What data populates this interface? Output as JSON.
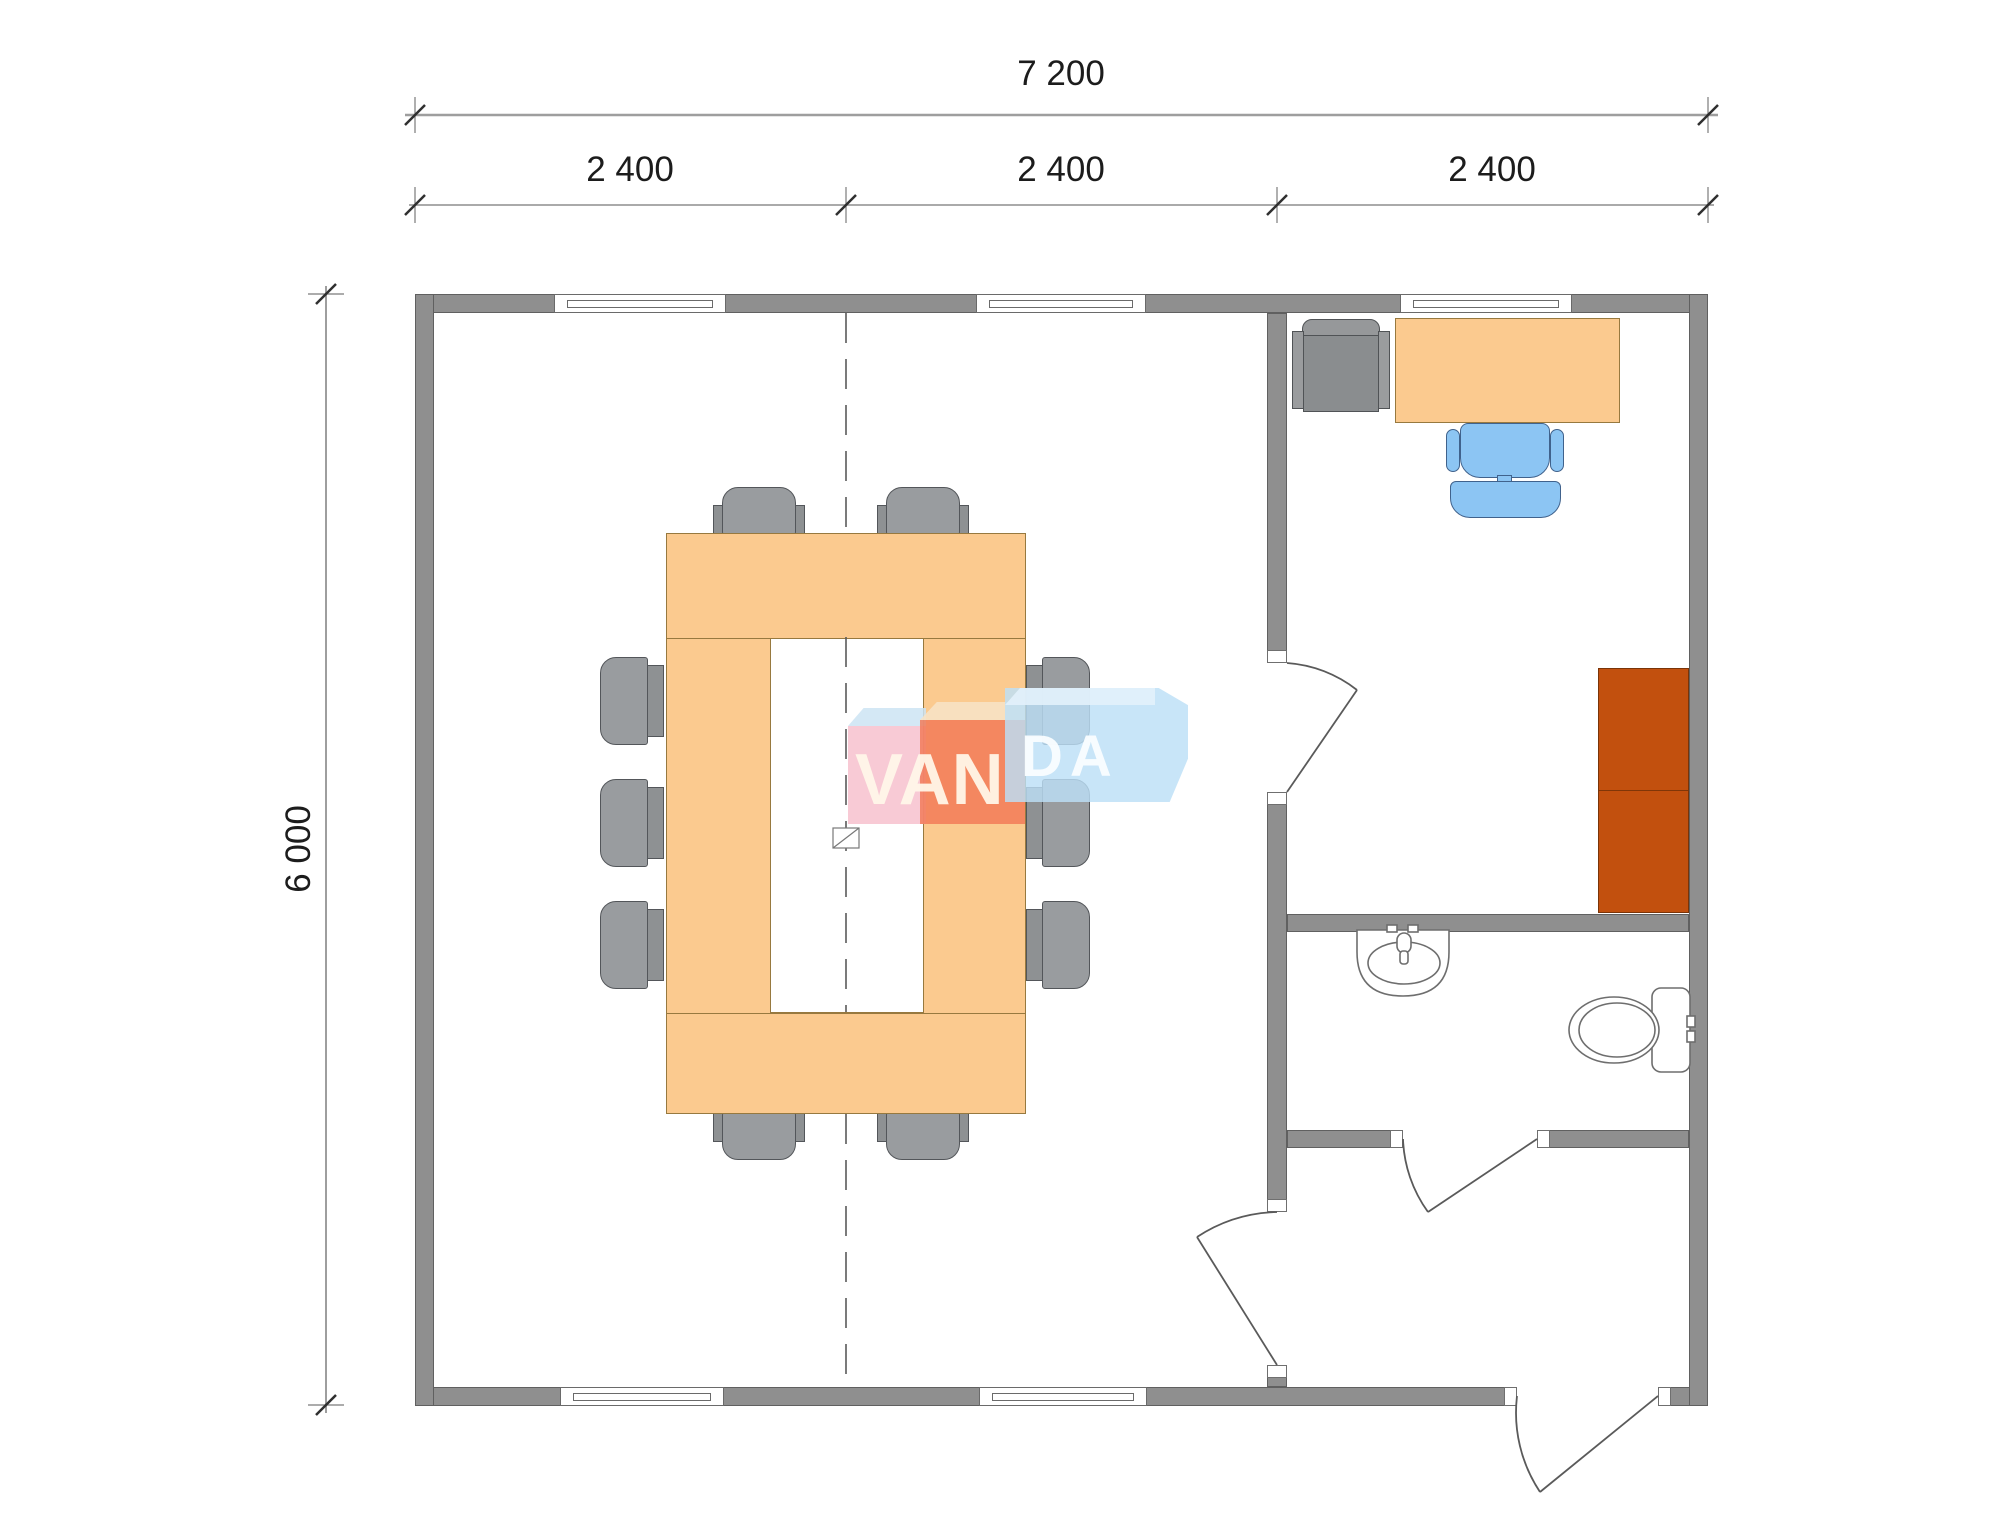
{
  "plan": {
    "type": "modular building floor plan",
    "background": "#ffffff",
    "wall_color": "#8f8f8f",
    "dimension_labels": {
      "total_width": "7 200",
      "modules": [
        "2 400",
        "2 400",
        "2 400"
      ],
      "total_height": "6 000"
    },
    "watermark": {
      "text": "VANDA",
      "text_left": "VAN",
      "text_right": "DA",
      "pink": "#f6becc",
      "red": "#f1775a",
      "blue": "#bcddf6"
    },
    "colors": {
      "tabletop_peach": "#fbca8f",
      "chair_gray": "#8e9193",
      "desk_chair_blue": "#8cc5f3",
      "wardrobe_rust": "#c2500e",
      "dimension_text": "#1c1c1c"
    },
    "counts": {
      "meeting_chairs": 10,
      "windows": 5,
      "door_swings": 4,
      "modules": 3
    }
  }
}
